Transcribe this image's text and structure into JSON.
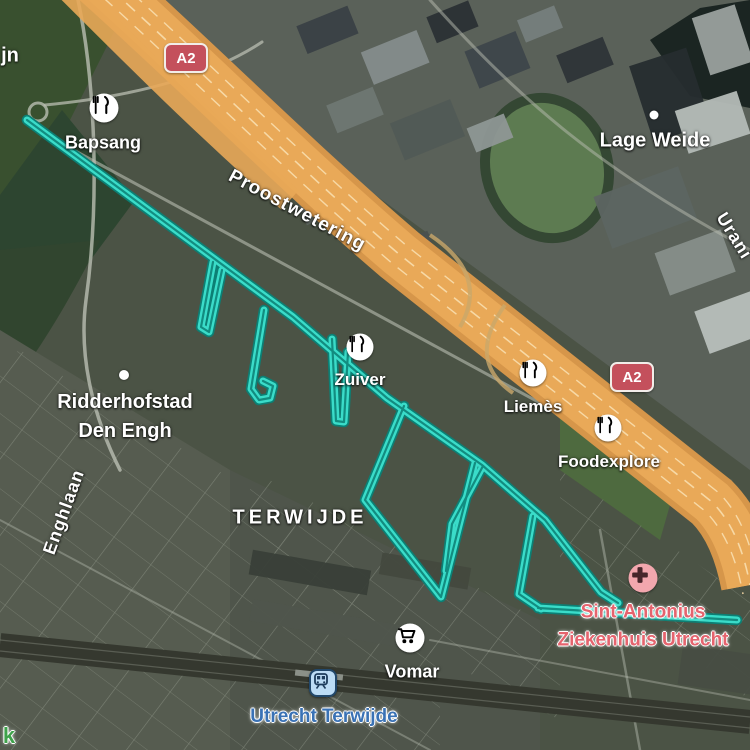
{
  "map": {
    "fragments": {
      "top_left": "jn",
      "bottom_left_park": "k"
    },
    "shields": [
      {
        "label": "A2"
      },
      {
        "label": "A2"
      }
    ],
    "roads": {
      "proostwetering": "Proostwetering",
      "enghlaan": "Enghlaan",
      "uraniumweg_partial": "Urani"
    },
    "places": {
      "lage_weide": "Lage Weide",
      "ridderhofstad_line1": "Ridderhofstad",
      "ridderhofstad_line2": "Den Engh",
      "terwijde": "TERWIJDE"
    },
    "pois": {
      "bapsang": "Bapsang",
      "zuiver": "Zuiver",
      "liemes": "Liemès",
      "foodexplore": "Foodexplore",
      "vomar": "Vomar"
    },
    "hospital": {
      "line1": "Sint-Antonius",
      "line2": "Ziekenhuis Utrecht"
    },
    "transit": {
      "label": "Utrecht Terwijde"
    },
    "colors": {
      "route": "#3adcc9",
      "route_casing": "#0c7f74",
      "highway": "#e9a958",
      "shield_bg": "#c4505c",
      "hospital_text": "#e5646e",
      "hospital_icon_bg": "#f2a7ae",
      "transit_text": "#3a72b5",
      "transit_icon_bg": "#bcdcf5",
      "park_text": "#3fa24b"
    }
  }
}
